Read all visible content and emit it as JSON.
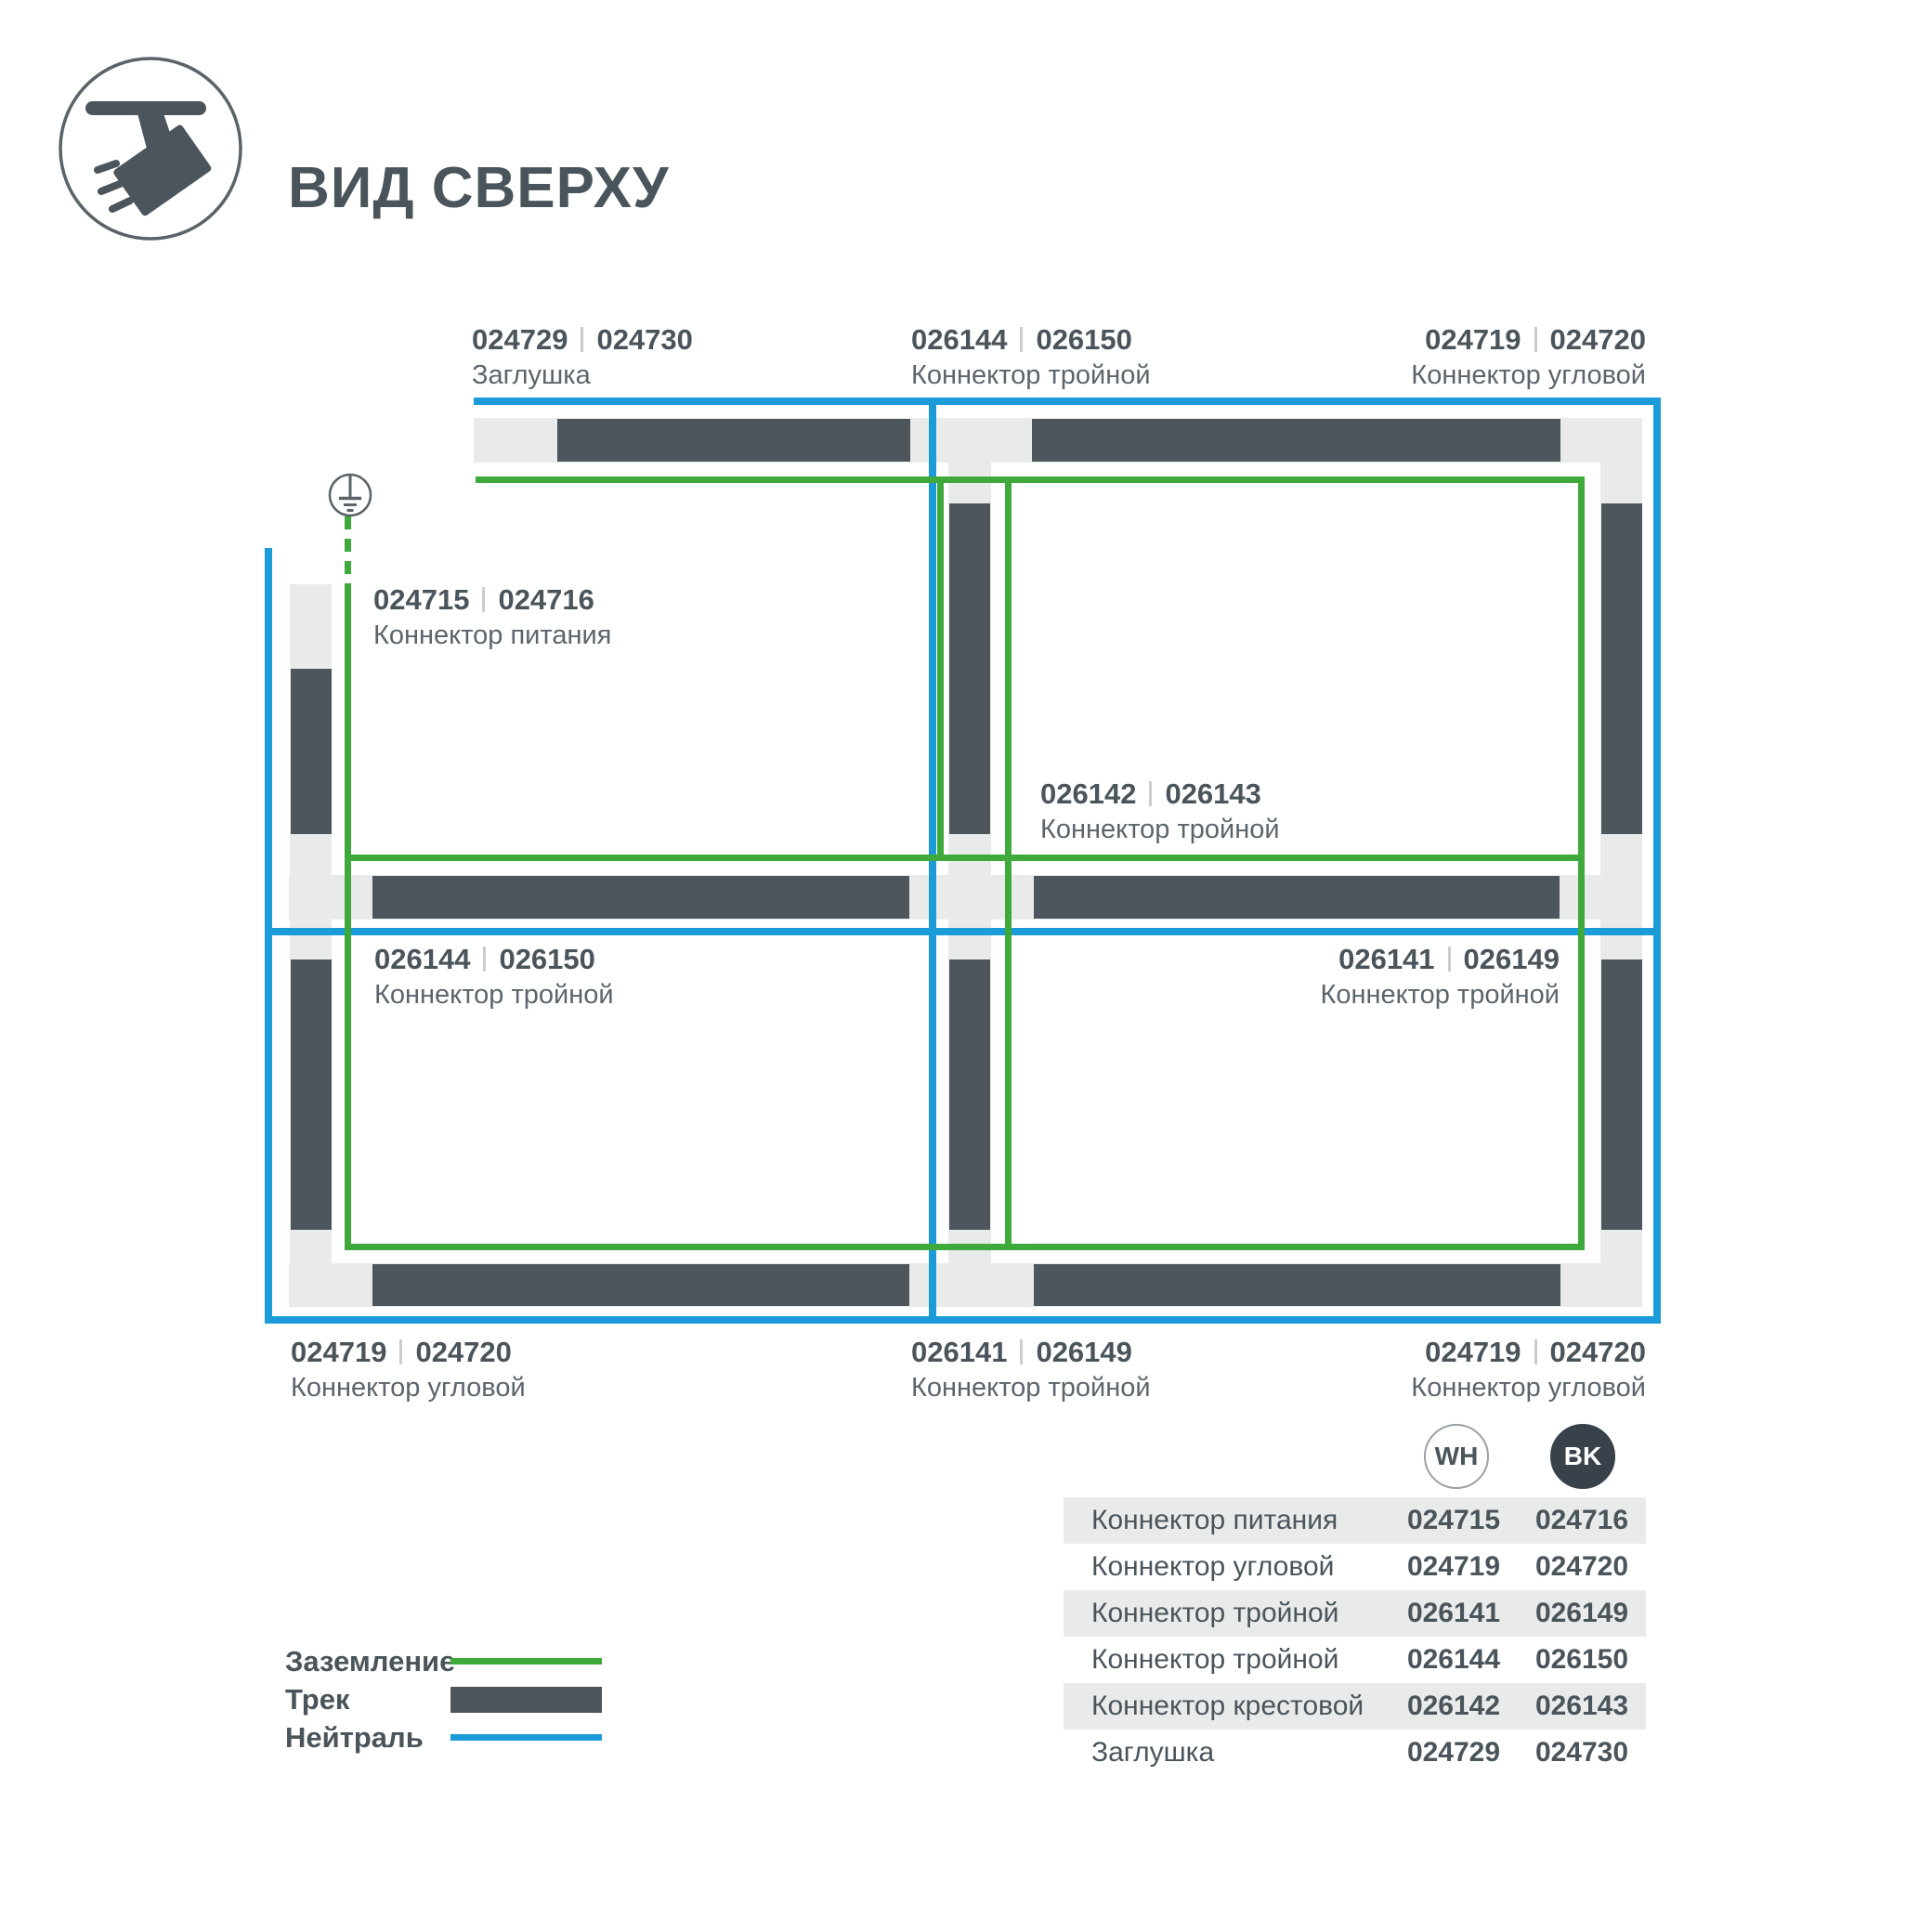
{
  "header": {
    "title": "ВИД СВЕРХУ"
  },
  "callouts": [
    {
      "wh": "024729",
      "bk": "024730",
      "name": "Заглушка"
    },
    {
      "wh": "026144",
      "bk": "026150",
      "name": "Коннектор тройной"
    },
    {
      "wh": "024719",
      "bk": "024720",
      "name": "Коннектор угловой"
    },
    {
      "wh": "024715",
      "bk": "024716",
      "name": "Коннектор питания"
    },
    {
      "wh": "026142",
      "bk": "026143",
      "name": "Коннектор тройной"
    },
    {
      "wh": "026144",
      "bk": "026150",
      "name": "Коннектор тройной"
    },
    {
      "wh": "026141",
      "bk": "026149",
      "name": "Коннектор тройной"
    },
    {
      "wh": "024719",
      "bk": "024720",
      "name": "Коннектор угловой"
    },
    {
      "wh": "026141",
      "bk": "026149",
      "name": "Коннектор тройной"
    },
    {
      "wh": "024719",
      "bk": "024720",
      "name": "Коннектор угловой"
    }
  ],
  "legend": {
    "items": [
      {
        "label": "Заземление",
        "swatch": "ground-line"
      },
      {
        "label": "Трек",
        "swatch": "track-bar"
      },
      {
        "label": "Нейтраль",
        "swatch": "neutral-line"
      }
    ]
  },
  "table": {
    "columns": {
      "wh": "WH",
      "bk": "BK"
    },
    "rows": [
      {
        "name": "Коннектор питания",
        "wh": "024715",
        "bk": "024716"
      },
      {
        "name": "Коннектор угловой",
        "wh": "024719",
        "bk": "024720"
      },
      {
        "name": "Коннектор тройной",
        "wh": "026141",
        "bk": "026149"
      },
      {
        "name": "Коннектор тройной",
        "wh": "026144",
        "bk": "026150"
      },
      {
        "name": "Коннектор крестовой",
        "wh": "026142",
        "bk": "026143"
      },
      {
        "name": "Заглушка",
        "wh": "024729",
        "bk": "024730"
      }
    ]
  },
  "colors": {
    "ground_green": "#3FA93B",
    "neutral_blue": "#1B9CD8",
    "track_dark": "#4C565C",
    "track_light": "#E9EBEB"
  }
}
